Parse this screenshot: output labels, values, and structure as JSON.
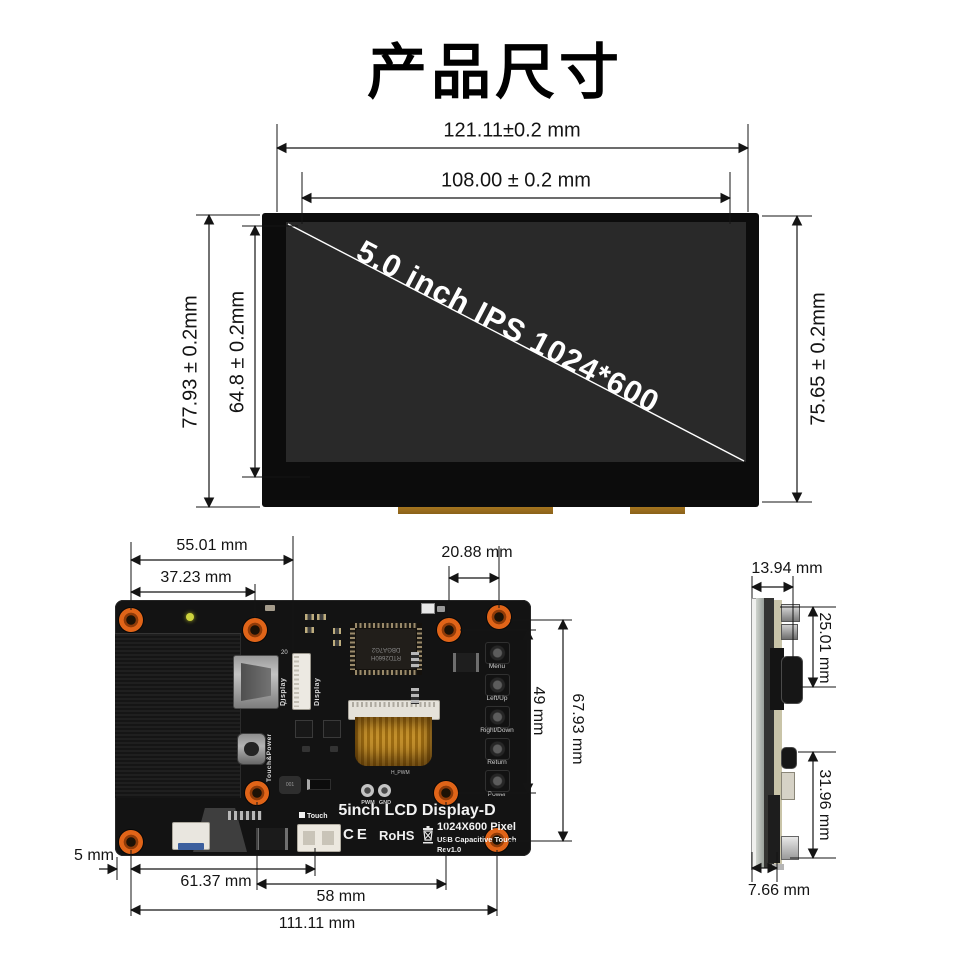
{
  "title": "产品尺寸",
  "front_view": {
    "screen_label": "5.0 inch IPS 1024*600",
    "dims": {
      "outer_width": "121.11±0.2 mm",
      "active_width": "108.00 ± 0.2 mm",
      "outer_height": "77.93 ± 0.2mm",
      "active_height": "64.8 ± 0.2mm",
      "right_height": "75.65 ± 0.2mm"
    }
  },
  "pcb_view": {
    "dims": {
      "top_55": "55.01 mm",
      "top_37": "37.23 mm",
      "top_20": "20.88 mm",
      "right_49": "49 mm",
      "right_67": "67.93 mm",
      "left_5": "5 mm",
      "bottom_61": "61.37 mm",
      "bottom_58": "58 mm",
      "bottom_111": "111.11 mm"
    },
    "labels": {
      "hdmi_port": "Display",
      "display_ffc": "Display",
      "ffc_pin_top": "20",
      "ffc_pin_bottom": "1",
      "usb_port": "Touch&Power",
      "touch_conn": "Touch",
      "pwm": "PWM",
      "gnd": "GND",
      "pwm_silk": "H_PWM",
      "product_name": "5inch LCD Display-D",
      "ce": "CE",
      "rohs": "RoHS",
      "pixels": "1024X600 Pixel",
      "touch_type": "USB Capacitive Touch",
      "rev": "Rev1.0",
      "chip_line1": "RTD2660H",
      "chip_line2": "DBGA7G2",
      "inductor": "001"
    },
    "buttons": [
      {
        "label": "Menu"
      },
      {
        "label": "Left/Up"
      },
      {
        "label": "Right/Down"
      },
      {
        "label": "Return"
      },
      {
        "label": "Power"
      }
    ]
  },
  "side_view": {
    "dims": {
      "depth_top": "13.94 mm",
      "top_to_hdmi": "25.01 mm",
      "usb_to_bottom": "31.96 mm",
      "panel_depth": "7.66 mm"
    }
  }
}
